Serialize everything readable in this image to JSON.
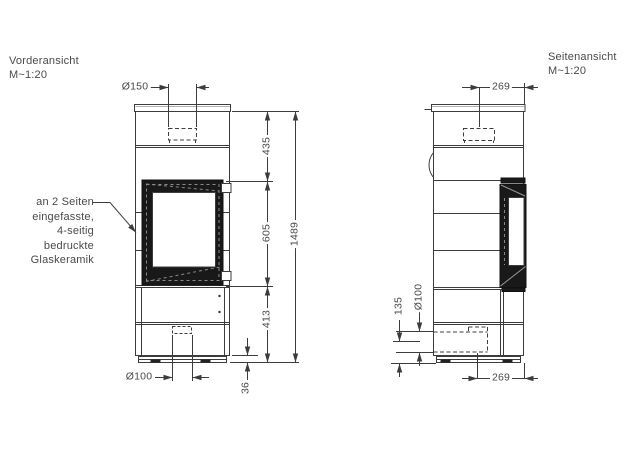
{
  "drawing": {
    "front_view": {
      "title": "Vorderansicht",
      "scale": "M~1:20",
      "dims": {
        "flue_diameter": "Ø150",
        "upper_height": "435",
        "glass_height": "605",
        "lower_height": "413",
        "total_height": "1489",
        "air_inlet_diameter": "Ø100",
        "plinth_height": "36"
      }
    },
    "side_view": {
      "title": "Seitenansicht",
      "scale": "M~1:20",
      "dims": {
        "flue_offset": "269",
        "depth": "269",
        "air_duct_diameter": "Ø100",
        "air_duct_center_height": "135"
      }
    },
    "annotation": {
      "lines": [
        "an 2 Seiten",
        "eingefasste,",
        "4-seitig",
        "bedruckte",
        "Glaskeramik"
      ]
    },
    "colors": {
      "line": "#3c3c3c",
      "glass_fill": "#191919",
      "text": "#4a4a4a"
    }
  }
}
